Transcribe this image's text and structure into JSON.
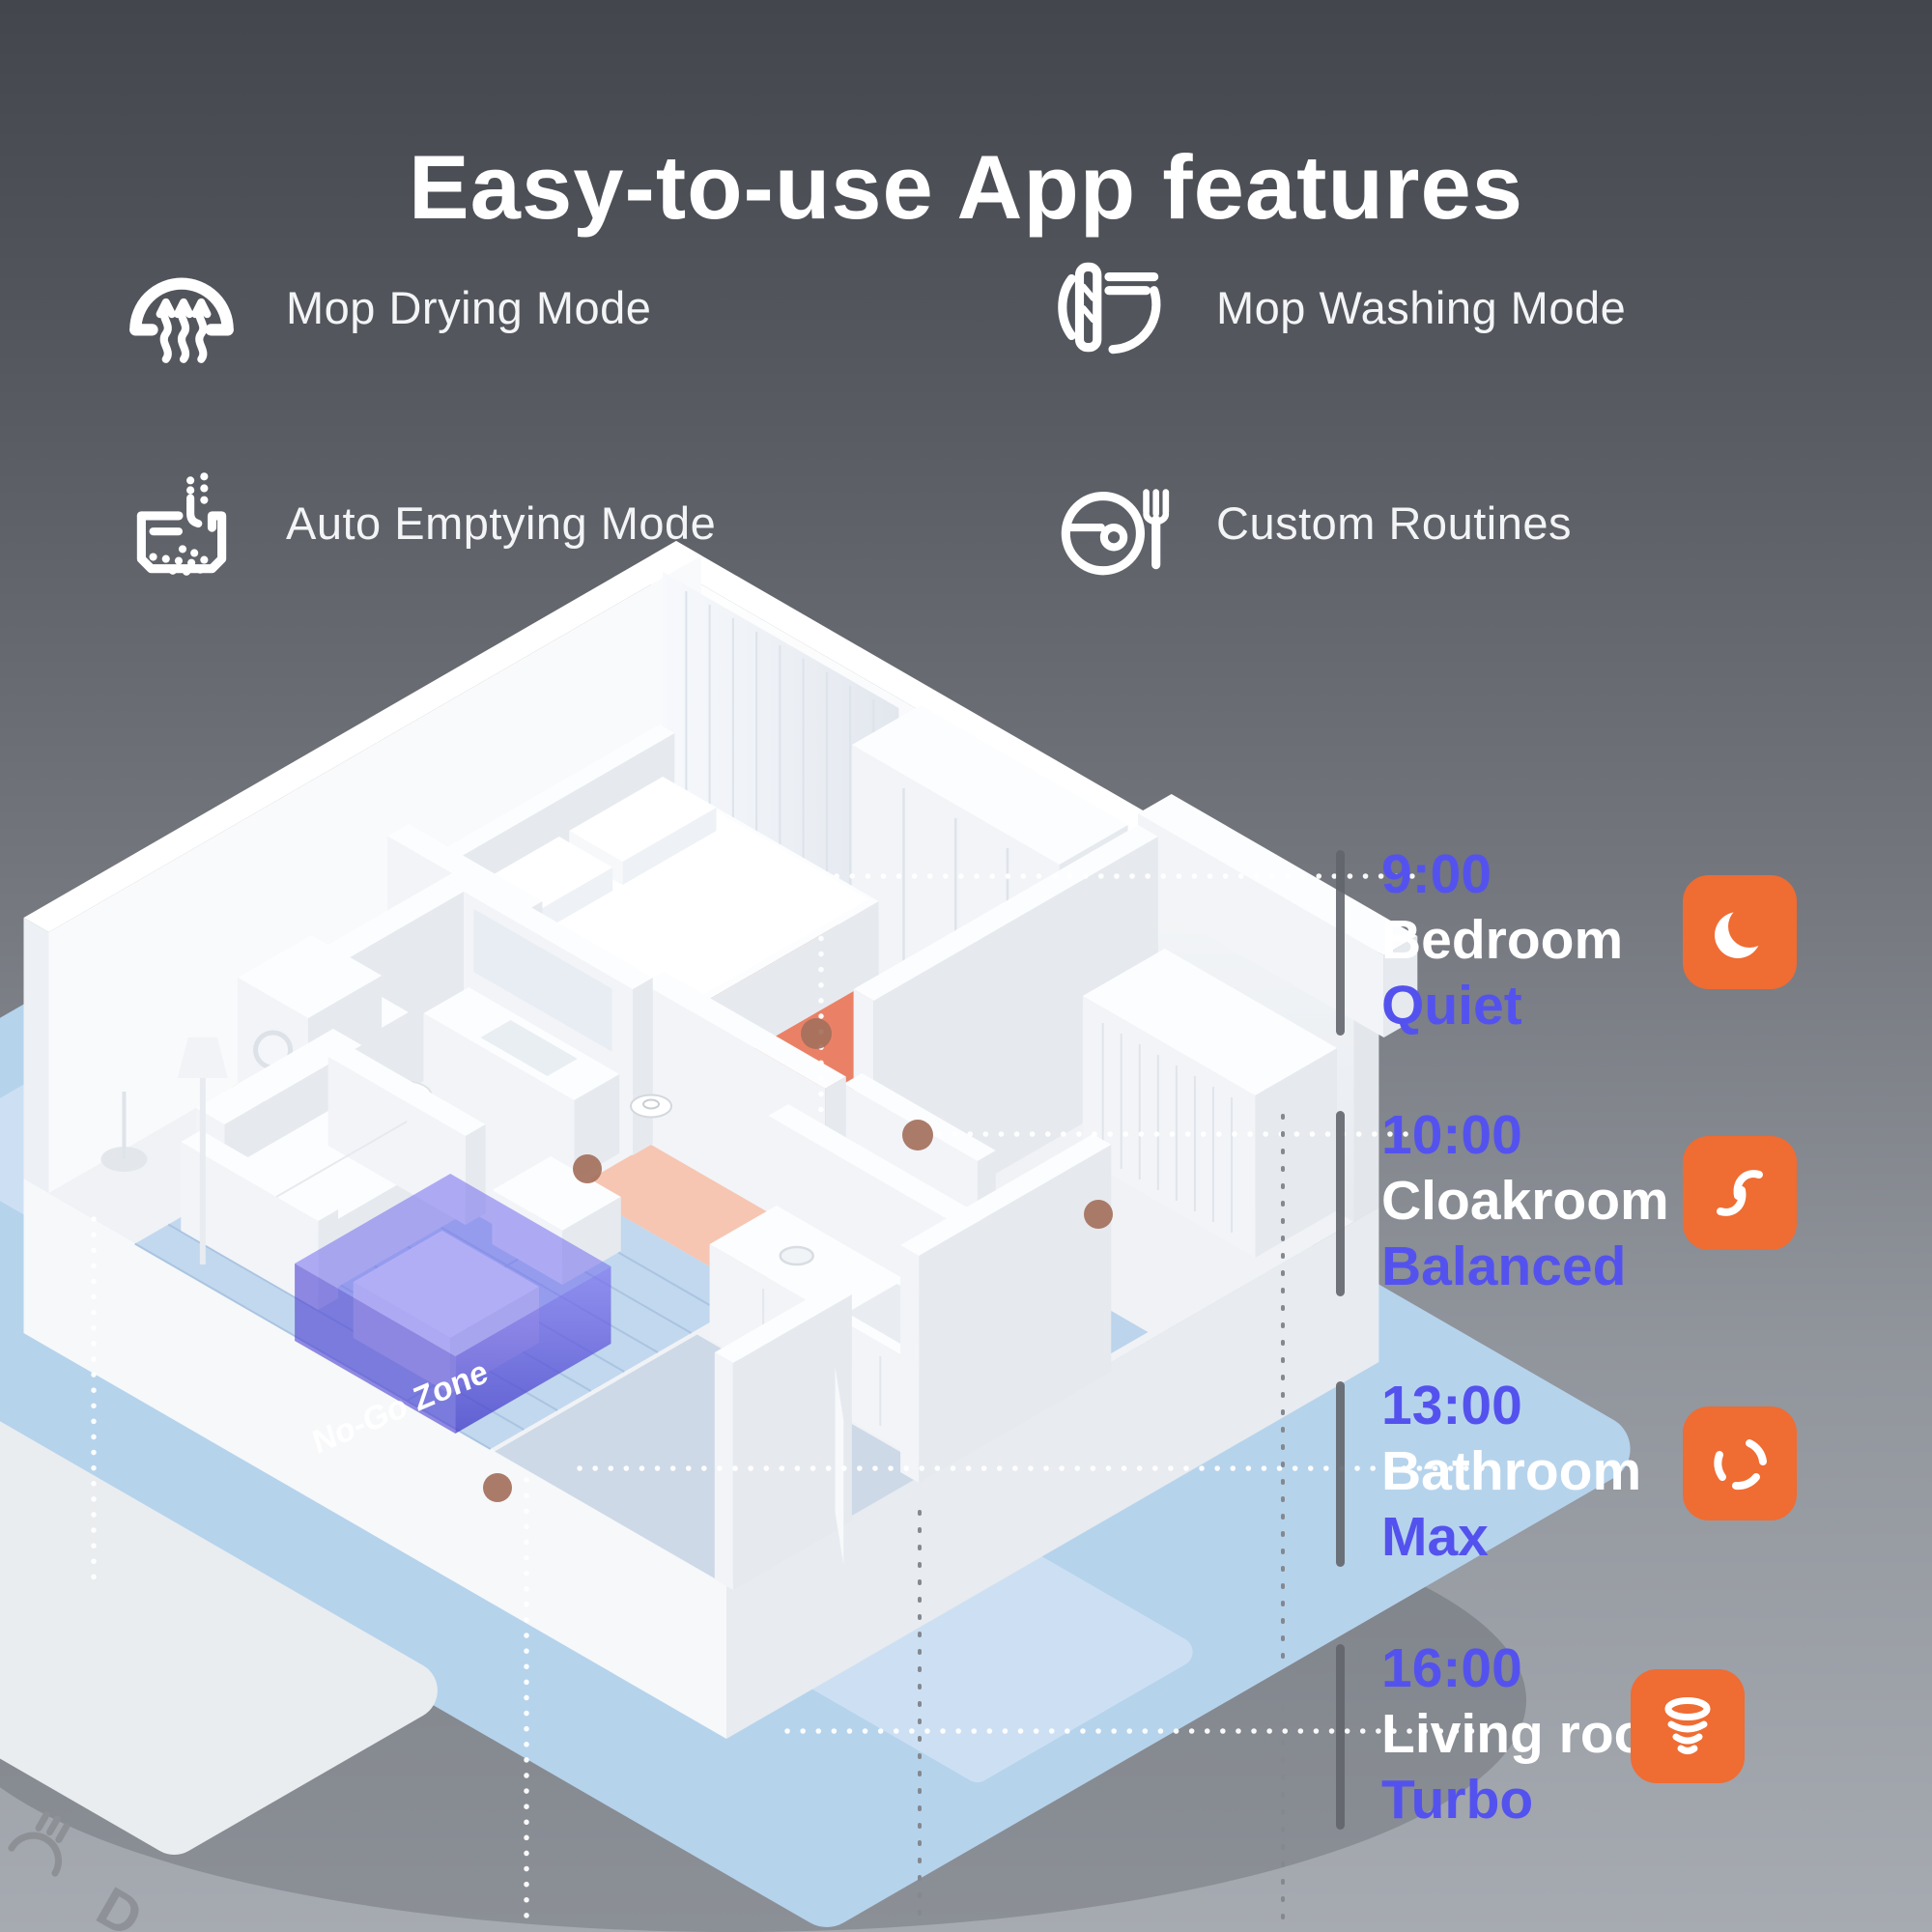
{
  "title": "Easy-to-use App features",
  "features": [
    {
      "label": "Mop Drying Mode",
      "icon": "mop-drying-icon"
    },
    {
      "label": "Auto Emptying Mode",
      "icon": "auto-emptying-icon"
    },
    {
      "label": "Mop Washing Mode",
      "icon": "mop-washing-icon"
    },
    {
      "label": "Custom Routines",
      "icon": "custom-routines-icon"
    }
  ],
  "floorplan": {
    "no_go_zone_label": "No-Go Zone",
    "phone_partial_label": "D",
    "zone_colors": {
      "bedroom": "#EA8166",
      "hallway": "#F6C6B2",
      "living_room": "#C2D8EE",
      "laundry": "#E7AA55",
      "cloakroom": "#BCD4EC",
      "no_go_zone": "#5B52E0"
    },
    "marker_color": "#A4705C"
  },
  "schedule": {
    "items": [
      {
        "time": "9:00",
        "room": "Bedroom",
        "mode": "Quiet",
        "icon": "quiet-moon-icon"
      },
      {
        "time": "10:00",
        "room": "Cloakroom",
        "mode": "Balanced",
        "icon": "balanced-fan-icon"
      },
      {
        "time": "13:00",
        "room": "Bathroom",
        "mode": "Max",
        "icon": "max-fan-icon"
      },
      {
        "time": "16:00",
        "room": "Living room",
        "mode": "Turbo",
        "icon": "turbo-fan-icon"
      }
    ],
    "time_color": "#5452EE",
    "room_color": "#FFFFFF",
    "mode_color": "#5452EE",
    "icon_bg": "#EF6C33"
  }
}
